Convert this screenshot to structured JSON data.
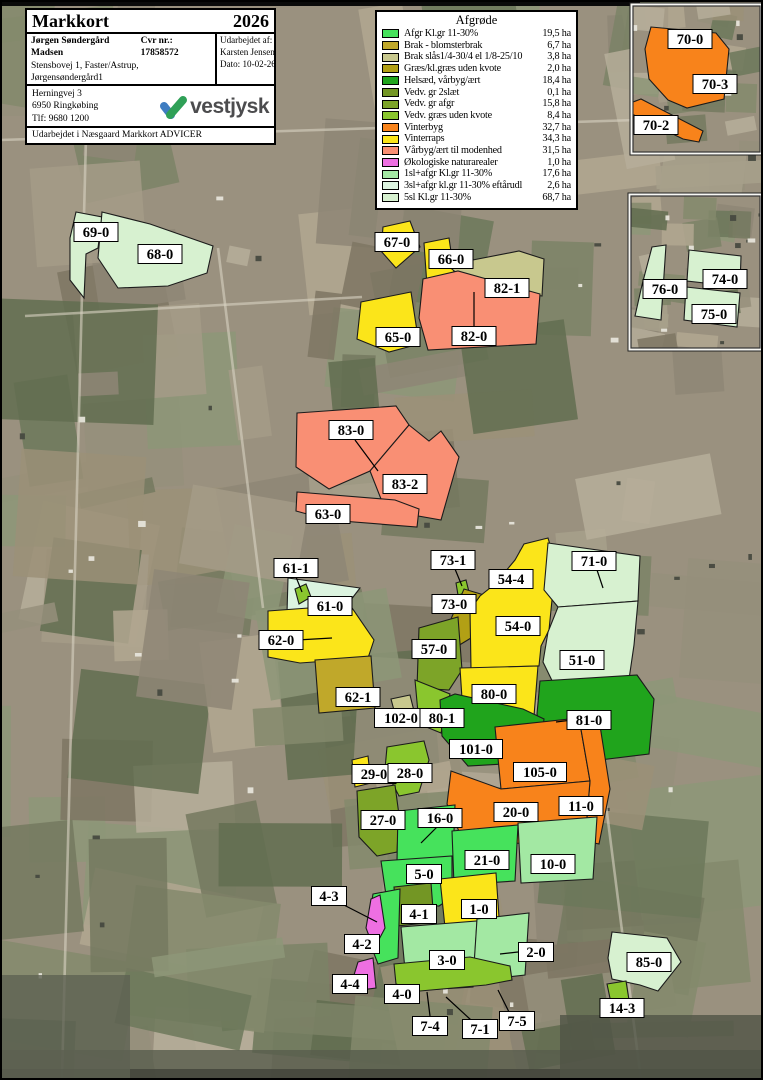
{
  "header": {
    "title": "Markkort",
    "year": "2026",
    "owner": "Jørgen Søndergård Madsen",
    "cvr": "Cvr nr.: 17858572",
    "address": "Stensbovej 1, Faster/Astrup, Jørgensøndergård1",
    "city": "6900 Skjern",
    "phone": "Tlf: 60943375",
    "member": "Medlems nr.: 5767",
    "prepared_by_label": "Udarbejdet af:",
    "prepared_by": "Karsten Jensen",
    "date": "Dato: 10-02-26"
  },
  "office": {
    "line1": "Herningvej 3",
    "line2": "6950 Ringkøbing",
    "line3": "Tlf: 9680 1200",
    "logo": "vestjysk",
    "logo_blue": "#3f7dc1",
    "logo_green": "#2fa057",
    "credit": "Udarbejdet i Næsgaard Markkort ADVICER"
  },
  "legend": {
    "title": "Afgrøde",
    "items": [
      {
        "key": "afgr",
        "label": "Afgr Kl.gr 11-30%",
        "area": "19,5 ha",
        "color": "#46e25c"
      },
      {
        "key": "brak_blomster",
        "label": "Brak - blomsterbrak",
        "area": "6,7 ha",
        "color": "#c0a82a"
      },
      {
        "key": "brak_slaas",
        "label": "Brak slås1/4-30/4 el 1/8-25/10",
        "area": "3,8 ha",
        "color": "#c8c88e"
      },
      {
        "key": "graes_kvote",
        "label": "Græs/kl.græs uden kvote",
        "area": "2,0 ha",
        "color": "#b2a015"
      },
      {
        "key": "helsaed",
        "label": "Helsæd, vårbyg/ært",
        "area": "18,4 ha",
        "color": "#20a41c"
      },
      {
        "key": "vedv2",
        "label": "Vedv. gr 2slæt",
        "area": "0,1 ha",
        "color": "#739624"
      },
      {
        "key": "vedv_afgr",
        "label": "Vedv. gr afgr",
        "area": "15,8 ha",
        "color": "#7da428"
      },
      {
        "key": "vedv_graes",
        "label": "Vedv. græs uden kvote",
        "area": "8,4 ha",
        "color": "#8ac62e"
      },
      {
        "key": "vinterbyg",
        "label": "Vinterbyg",
        "area": "32,7 ha",
        "color": "#f8831b"
      },
      {
        "key": "vinterraps",
        "label": "Vinterraps",
        "area": "34,3 ha",
        "color": "#fbe51a"
      },
      {
        "key": "vaarbyg",
        "label": "Vårbyg/ært til modenhed",
        "area": "31,5 ha",
        "color": "#f98f74"
      },
      {
        "key": "oko",
        "label": "Økologiske naturarealer",
        "area": "1,0 ha",
        "color": "#ee6fe2"
      },
      {
        "key": "sl1",
        "label": "1sl+afgr Kl.gr 11-30%",
        "area": "17,6 ha",
        "color": "#a3e8a3"
      },
      {
        "key": "sl3",
        "label": "3sl+afgr kl.gr 11-30% eftårudl",
        "area": "2,6 ha",
        "color": "#dcf4e0"
      },
      {
        "key": "sl5",
        "label": "5sl Kl.gr 11-30%",
        "area": "68,7 ha",
        "color": "#d7f1d0"
      }
    ]
  },
  "map": {
    "aerial_base": "#9a917f",
    "aerial_palette": [
      "#8e8675",
      "#a49b87",
      "#b1a791",
      "#7b8266",
      "#6c785a",
      "#958f7b",
      "#848a6c",
      "#a7a08b",
      "#74795f",
      "#9b9078",
      "#616d50",
      "#b6ae9a",
      "#7e7663",
      "#8d9678"
    ],
    "seed": 7,
    "fields": [
      {
        "label": "69-0",
        "crop": "sl5",
        "points": "76,212 102,217 98,248 86,254 84,298 70,280 70,238",
        "lx": 96,
        "ly": 232
      },
      {
        "label": "68-0",
        "crop": "sl5",
        "points": "102,212 150,224 213,246 207,273 168,286 118,288 98,258",
        "lx": 160,
        "ly": 254
      },
      {
        "label": "67-0",
        "crop": "vinterraps",
        "points": "383,227 410,221 420,247 396,268 381,251",
        "lx": 397,
        "ly": 242
      },
      {
        "label": "66-0",
        "crop": "vinterraps",
        "points": "424,243 449,238 455,279 427,286",
        "lx": 451,
        "ly": 259
      },
      {
        "label": "82-1",
        "crop": "brak_slaas",
        "points": "447,265 519,251 544,259 542,296 470,284",
        "lx": 507,
        "ly": 288
      },
      {
        "label": "82-0",
        "crop": "vaarbyg",
        "points": "423,279 458,271 540,294 536,344 428,350 419,318",
        "lx": 474,
        "ly": 336,
        "leader": [
          474,
          328,
          474,
          292
        ]
      },
      {
        "label": "65-0",
        "crop": "vinterraps",
        "points": "361,302 411,292 419,344 389,352 357,339",
        "lx": 398,
        "ly": 337
      },
      {
        "label": "83-0",
        "crop": "vaarbyg",
        "points": "297,413 396,406 409,425 370,471 329,489 296,467",
        "lx": 351,
        "ly": 430,
        "leader": [
          355,
          440,
          378,
          471
        ]
      },
      {
        "label": "83-2",
        "crop": "vaarbyg",
        "points": "409,425 429,441 441,431 459,457 441,520 407,514 381,499 370,471",
        "lx": 405,
        "ly": 484
      },
      {
        "label": "63-0",
        "crop": "vaarbyg",
        "points": "297,492 395,500 419,509 417,527 329,520 296,511",
        "lx": 328,
        "ly": 514
      },
      {
        "label": "61-0",
        "crop": "sl3",
        "points": "288,578 360,588 337,618 287,613",
        "lx": 330,
        "ly": 606
      },
      {
        "label": "61-1",
        "crop": "vedv_graes",
        "points": "295,589 306,584 311,597 299,604",
        "lx": 296,
        "ly": 568,
        "leader": [
          296,
          577,
          302,
          592
        ]
      },
      {
        "label": "62-0",
        "crop": "vinterraps",
        "points": "268,611 350,605 374,640 368,658 300,663 268,657",
        "lx": 281,
        "ly": 640,
        "leader": [
          297,
          640,
          332,
          638
        ]
      },
      {
        "label": "62-1",
        "crop": "brak_blomster",
        "points": "315,660 371,656 375,708 319,713",
        "lx": 358,
        "ly": 697
      },
      {
        "label": "73-1",
        "crop": "vedv_graes",
        "points": "456,583 466,580 469,592 458,595",
        "lx": 453,
        "ly": 560,
        "leader": [
          455,
          569,
          462,
          586
        ]
      },
      {
        "label": "73-0",
        "crop": "graes_kvote",
        "points": "464,589 484,595 471,638 448,652 444,635",
        "lx": 454,
        "ly": 604
      },
      {
        "label": "54-0",
        "crop": "vinterraps",
        "points": "471,668 470,610 480,596 495,584 515,560 524,544 548,538 557,568 552,600 549,630 541,646 539,666",
        "lx": 518,
        "ly": 626
      },
      {
        "label": "54-4",
        "crop": "vinterraps",
        "lx": 511,
        "ly": 579
      },
      {
        "label": "57-0",
        "crop": "vedv_afgr",
        "points": "419,628 458,617 462,670 449,690 417,688",
        "lx": 434,
        "ly": 649
      },
      {
        "label": "71-0",
        "crop": "sl5",
        "points": "548,543 640,556 638,601 558,607 544,590",
        "lx": 594,
        "ly": 561,
        "leader": [
          597,
          570,
          603,
          588
        ]
      },
      {
        "label": "51-0",
        "crop": "sl5",
        "points": "558,607 638,601 634,645 627,693 560,697 543,662 548,632",
        "lx": 582,
        "ly": 660
      },
      {
        "label": "80-0",
        "crop": "vinterraps",
        "points": "460,668 538,666 534,716 463,714",
        "lx": 494,
        "ly": 694
      },
      {
        "label": "102-0",
        "crop": "brak_slaas",
        "points": "391,699 410,695 414,711 395,714",
        "lx": 401,
        "ly": 718
      },
      {
        "label": "80-1",
        "crop": "vedv_graes",
        "points": "415,680 450,694 441,733 419,724",
        "lx": 442,
        "ly": 718
      },
      {
        "label": "81-0",
        "crop": "helsaed",
        "points": "540,681 637,675 654,699 649,754 600,760 545,750 537,714",
        "lx": 589,
        "ly": 720,
        "leader": [
          572,
          720,
          556,
          722
        ]
      },
      {
        "label": "101-0",
        "crop": "helsaed",
        "points": "440,700 455,694 523,709 544,719 539,762 468,766 442,736",
        "lx": 476,
        "ly": 749
      },
      {
        "label": "105-0",
        "crop": "vinterbyg",
        "points": "495,727 579,718 590,781 501,789",
        "lx": 540,
        "ly": 772
      },
      {
        "label": "11-0",
        "crop": "vinterbyg",
        "points": "579,718 598,713 610,789 599,844 585,841 590,781",
        "lx": 581,
        "ly": 806
      },
      {
        "label": "20-0",
        "crop": "vinterbyg",
        "points": "451,771 501,789 590,781 585,841 465,845 447,804",
        "lx": 516,
        "ly": 812
      },
      {
        "label": "29-0",
        "crop": "vinterraps",
        "points": "352,760 368,756 371,783 355,787",
        "lx": 374,
        "ly": 774
      },
      {
        "label": "28-0",
        "crop": "vedv_graes",
        "points": "387,747 424,741 429,760 419,792 399,796 385,769",
        "lx": 410,
        "ly": 773
      },
      {
        "label": "27-0",
        "crop": "vedv_afgr",
        "points": "357,791 395,785 399,815 397,852 377,856 359,837",
        "lx": 383,
        "ly": 820
      },
      {
        "label": "16-0",
        "crop": "afgr",
        "points": "398,811 455,805 453,857 397,861",
        "lx": 440,
        "ly": 818,
        "leader": [
          437,
          827,
          421,
          843
        ]
      },
      {
        "label": "21-0",
        "crop": "afgr",
        "points": "452,831 518,825 515,881 454,885",
        "lx": 487,
        "ly": 860
      },
      {
        "label": "10-0",
        "crop": "sl1",
        "points": "518,823 597,817 593,879 521,883",
        "lx": 553,
        "ly": 864
      },
      {
        "label": "5-0",
        "crop": "afgr",
        "points": "381,861 452,856 452,880 448,900 439,906 387,902",
        "lx": 424,
        "ly": 874
      },
      {
        "label": "4-1",
        "crop": "vedv2",
        "points": "394,887 431,883 434,922 397,926",
        "lx": 419,
        "ly": 914
      },
      {
        "label": "1-0",
        "crop": "vinterraps",
        "points": "440,879 496,873 500,932 446,937",
        "lx": 479,
        "ly": 909
      },
      {
        "label": "4-2",
        "crop": "afgr",
        "points": "373,894 400,889 398,958 378,964 368,938 380,928 370,912",
        "lx": 362,
        "ly": 944
      },
      {
        "label": "4-3",
        "crop": "oko",
        "points": "371,899 380,895 385,928 374,949 366,928",
        "lx": 329,
        "ly": 896,
        "leader": [
          340,
          903,
          377,
          922
        ]
      },
      {
        "label": "3-0",
        "crop": "sl1",
        "points": "401,927 477,921 473,987 407,991",
        "lx": 447,
        "ly": 960
      },
      {
        "label": "2-0",
        "crop": "sl1",
        "points": "477,919 529,913 525,975 473,981",
        "lx": 536,
        "ly": 952,
        "leader": [
          518,
          952,
          500,
          954
        ]
      },
      {
        "label": "4-4",
        "crop": "oko",
        "points": "358,962 373,958 376,988 360,990 354,975",
        "lx": 350,
        "ly": 984
      },
      {
        "label": "4-0",
        "crop": "vedv_graes",
        "points": "394,964 470,957 510,966 512,980 486,985 420,991 396,984",
        "lx": 402,
        "ly": 994
      },
      {
        "label": "7-4",
        "crop": "vedv_graes",
        "lx": 430,
        "ly": 1026,
        "leader": [
          430,
          1016,
          427,
          992
        ]
      },
      {
        "label": "7-1",
        "crop": "vedv_graes",
        "lx": 480,
        "ly": 1029,
        "leader": [
          471,
          1020,
          446,
          997
        ]
      },
      {
        "label": "7-5",
        "crop": "vedv_graes",
        "lx": 517,
        "ly": 1021,
        "leader": [
          509,
          1012,
          498,
          990
        ]
      },
      {
        "label": "85-0",
        "crop": "sl5",
        "points": "612,932 667,938 681,962 658,991 640,985 612,979 608,958",
        "lx": 649,
        "ly": 962
      },
      {
        "label": "14-3",
        "crop": "vedv_graes",
        "points": "607,984 626,981 629,1000 611,1003",
        "lx": 622,
        "ly": 1008
      }
    ],
    "insets": [
      {
        "x": 633,
        "y": 6,
        "w": 127,
        "h": 146,
        "seed": 11,
        "fields": [
          {
            "label": "70-0",
            "crop": "vinterbyg",
            "points": "651,27 716,33 729,49 724,99 687,108 668,100 649,79 645,49",
            "lx": 690,
            "ly": 39
          },
          {
            "label": "70-3",
            "crop": "vinterbyg",
            "lx": 715,
            "ly": 84
          },
          {
            "label": "70-2",
            "crop": "vinterbyg",
            "points": "633,102 641,99 703,131 699,142 683,139 632,114",
            "lx": 656,
            "ly": 125
          }
        ]
      },
      {
        "x": 631,
        "y": 196,
        "w": 129,
        "h": 152,
        "seed": 23,
        "fields": [
          {
            "label": "76-0",
            "crop": "sl5",
            "points": "652,247 666,245 661,320 635,316 642,285",
            "lx": 665,
            "ly": 289
          },
          {
            "label": "74-0",
            "crop": "sl5",
            "points": "689,250 741,256 740,287 687,281",
            "lx": 725,
            "ly": 279
          },
          {
            "label": "75-0",
            "crop": "sl5",
            "points": "686,287 740,293 737,327 684,320",
            "lx": 714,
            "ly": 314
          }
        ]
      }
    ]
  }
}
